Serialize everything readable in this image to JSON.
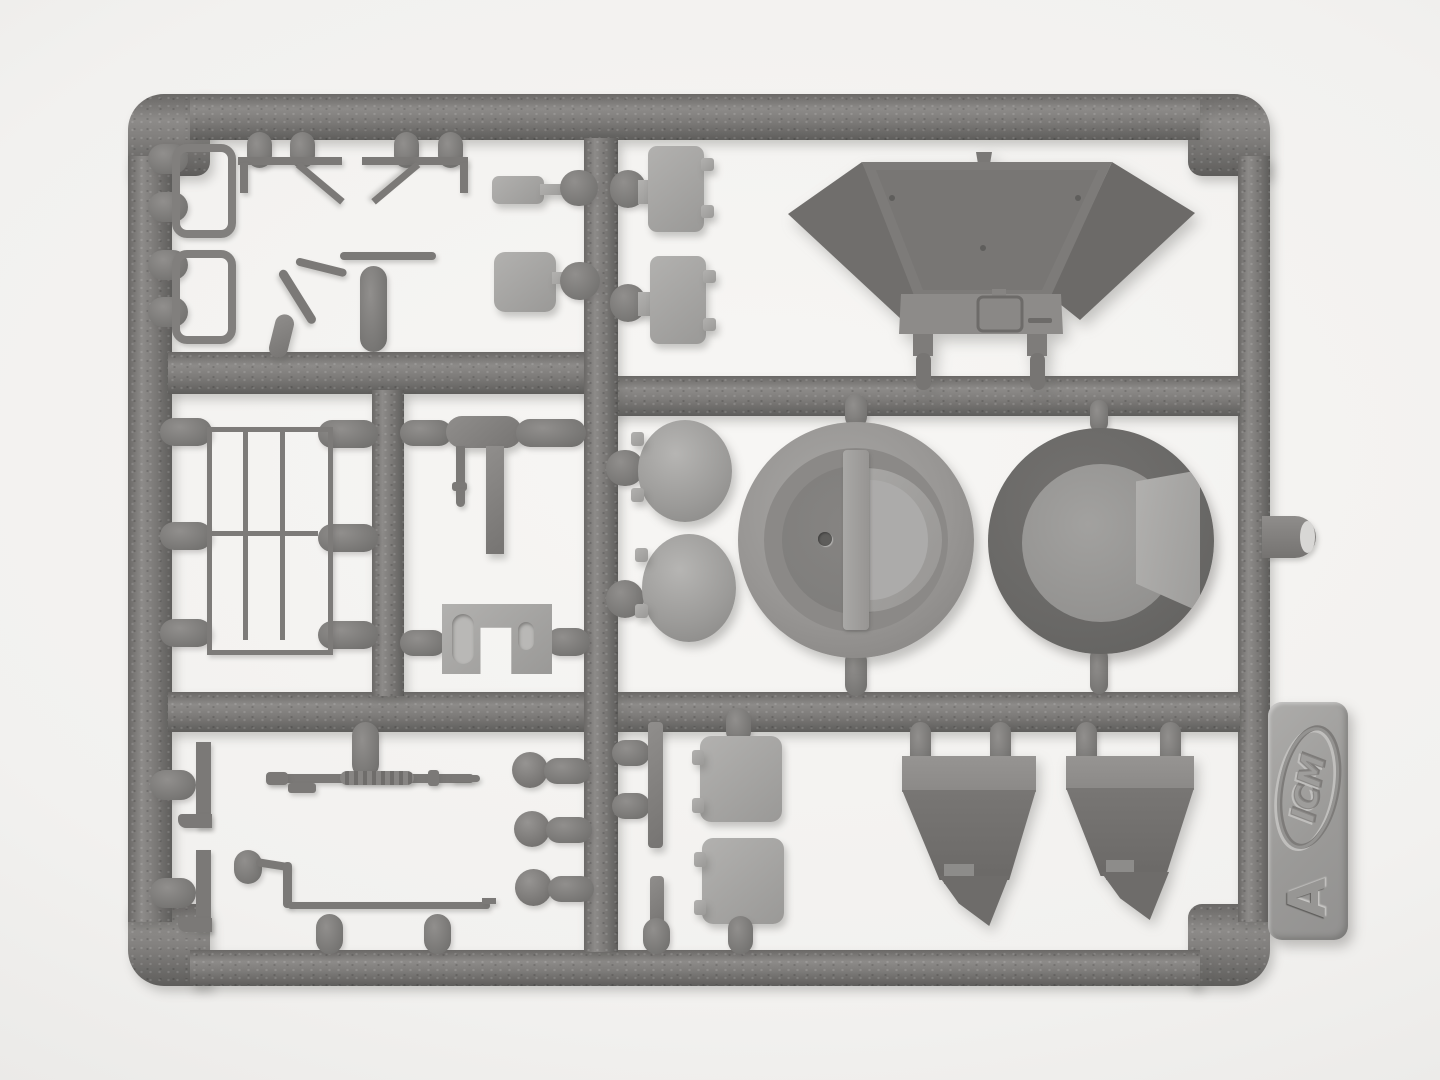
{
  "meta": {
    "type": "photograph",
    "subject": "Injection-moulded grey plastic model-kit sprue (parts runner) photographed on white paper"
  },
  "sprue": {
    "tab_letter": "A",
    "brand_logo_text": "ICM",
    "material_look": "grey styrene plastic, stippled runner texture, embossed logo tab",
    "colors": {
      "paper": "#f3f2f0",
      "paper_edge": "#dcdbd9",
      "plastic_runner": "#7b7977",
      "plastic_dark": "#636260",
      "plastic_mid": "#8a8886",
      "plastic_light": "#a6a5a3",
      "label_tab": "#a2a19f",
      "cut_stub_face": "#d8d7d5"
    },
    "parts": [
      {
        "name": "grab handle loop",
        "qty": 2,
        "area": "top-left cell"
      },
      {
        "name": "footstep bracket with diagonal brace",
        "qty": 2,
        "area": "top-left cell"
      },
      {
        "name": "bent rod / periscope arm",
        "qty": 1,
        "area": "top-left cell"
      },
      {
        "name": "small rectangular paddle plate",
        "qty": 1,
        "area": "top-left cell"
      },
      {
        "name": "square paddle plate",
        "qty": 1,
        "area": "top-left cell"
      },
      {
        "name": "access hatch panel with hinge tabs",
        "qty": 2,
        "area": "top-right cell"
      },
      {
        "name": "large winged hopper / casemate hull piece with hatch detail",
        "qty": 1,
        "area": "top-right cell"
      },
      {
        "name": "domed hatch cover",
        "qty": 2,
        "area": "middle-right cell"
      },
      {
        "name": "circular hatch ring with D-shaped lid",
        "qty": 1,
        "area": "middle-right cell"
      },
      {
        "name": "large round cupola ring with opening",
        "qty": 1,
        "area": "middle-right cell"
      },
      {
        "name": "barred grille / railing panel",
        "qty": 1,
        "area": "middle-left cell"
      },
      {
        "name": "cylinder with hanging rod and flat bar",
        "qty": 1,
        "area": "middle-center cell"
      },
      {
        "name": "U-bracket with two slotted holes",
        "qty": 1,
        "area": "middle-center cell"
      },
      {
        "name": "L-shaped bracket",
        "qty": 2,
        "area": "bottom-left cell"
      },
      {
        "name": "machine-gun barrel",
        "qty": 1,
        "area": "bottom-left cell"
      },
      {
        "name": "long bent handrail",
        "qty": 1,
        "area": "bottom-left cell"
      },
      {
        "name": "round disc / lamp",
        "qty": 3,
        "area": "bottom-left cell"
      },
      {
        "name": "thin flat strip",
        "qty": 2,
        "area": "bottom-right cell"
      },
      {
        "name": "square hatch panel with hinge tabs",
        "qty": 2,
        "area": "bottom-right cell"
      },
      {
        "name": "tapered splash-guard wedge",
        "qty": 2,
        "area": "bottom-right cell"
      },
      {
        "name": "cut-off runner stub",
        "qty": 1,
        "area": "right outer edge"
      }
    ]
  }
}
